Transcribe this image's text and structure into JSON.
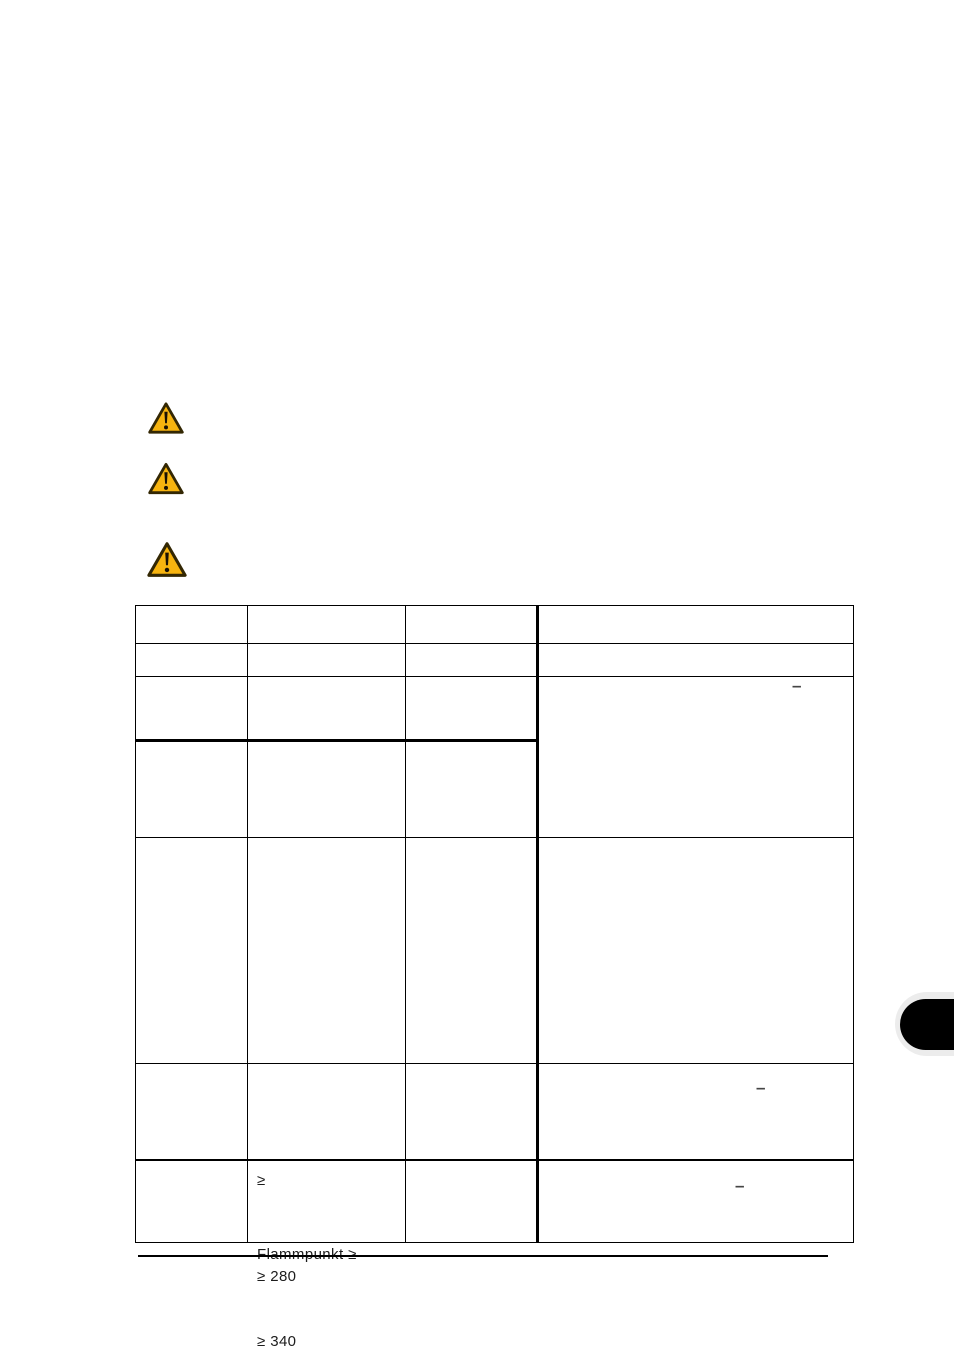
{
  "document": {
    "kind": "manual-page-scan",
    "icons": [
      {
        "name": "warning-icon"
      },
      {
        "name": "warning-icon"
      },
      {
        "name": "warning-icon"
      }
    ],
    "table": {
      "columns": 4,
      "rows": 7,
      "merged_row3_col4_dash": "–",
      "row6_col2_line1": "≥",
      "row6_col2_line2": "≥ 280",
      "row6_col4_dash": "–",
      "row7_col2_line1": "Flammpunkt ≥",
      "row7_col2_line2": "≥ 340",
      "row7_col4_dash": "–"
    },
    "colors": {
      "warning_fill": "#F7B40F",
      "warning_stroke": "#332703",
      "warning_glyph": "#191104",
      "table_border": "#000000",
      "dash_color": "#454545",
      "edge_tab": "#000000",
      "edge_tab_halo": "#ECECEC"
    }
  }
}
